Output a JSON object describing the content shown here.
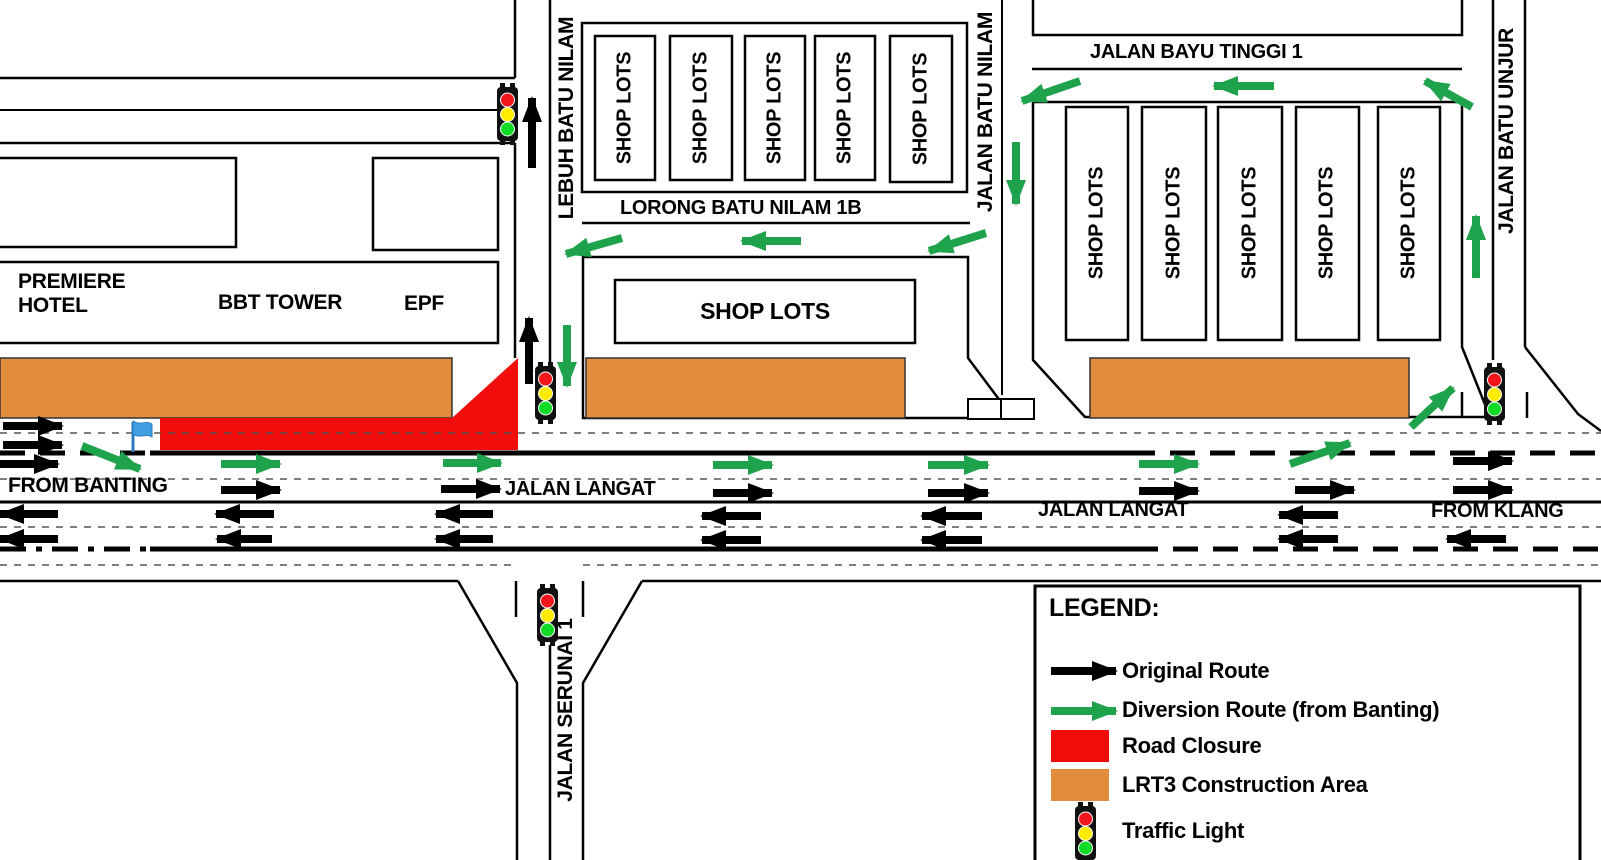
{
  "labels": {
    "premiere_hotel": "PREMIERE\nHOTEL",
    "bbt_tower": "BBT TOWER",
    "epf": "EPF",
    "lebuh_batu_nilam": "LEBUH BATU NILAM",
    "shop_lots": "SHOP LOTS",
    "lorong_batu_nilam_1b": "LORONG BATU NILAM 1B",
    "jalan_batu_nilam": "JALAN BATU NILAM",
    "jalan_bayu_tinggi_1": "JALAN BAYU TINGGI 1",
    "jalan_batu_unjur": "JALAN BATU UNJUR",
    "jalan_serunai_1": "JALAN SERUNAI 1",
    "from_banting": "FROM BANTING",
    "from_klang": "FROM KLANG",
    "jalan_langat_west": "JALAN LANGAT",
    "jalan_langat_east": "JALAN LANGAT"
  },
  "legend": {
    "title": "LEGEND:",
    "items": [
      {
        "id": "original-route",
        "label": "Original Route"
      },
      {
        "id": "diversion-route",
        "label": "Diversion Route (from Banting)"
      },
      {
        "id": "road-closure",
        "label": "Road Closure"
      },
      {
        "id": "construction",
        "label": "LRT3 Construction Area"
      },
      {
        "id": "traffic-light",
        "label": "Traffic Light"
      }
    ]
  },
  "colors": {
    "original_route": "#000000",
    "diversion_route": "#1FA24C",
    "road_closure": "#F20D0D",
    "construction_area": "#E28C3E",
    "traffic_light_red": "#F2151C",
    "traffic_light_yellow": "#FFEB00",
    "traffic_light_green": "#10DC28",
    "flag_blue": "#3F9FE0"
  },
  "map": {
    "traffic_lights": [
      [
        497,
        87
      ],
      [
        535,
        366
      ],
      [
        1484,
        367
      ],
      [
        537,
        588
      ],
      [
        1075,
        806
      ]
    ],
    "arrows": {
      "original": [
        [
          532,
          168,
          532,
          98
        ],
        [
          529,
          384,
          529,
          318
        ],
        [
          3,
          426,
          62,
          426
        ],
        [
          3,
          445,
          62,
          445
        ],
        [
          0,
          464,
          58,
          464
        ],
        [
          221,
          490,
          280,
          490
        ],
        [
          441,
          489,
          500,
          489
        ],
        [
          713,
          493,
          772,
          493
        ],
        [
          928,
          493,
          988,
          493
        ],
        [
          1139,
          491,
          1198,
          491
        ],
        [
          1295,
          490,
          1354,
          490
        ],
        [
          1453,
          490,
          1512,
          490
        ],
        [
          1453,
          461,
          1512,
          461
        ],
        [
          58,
          514,
          0,
          514
        ],
        [
          274,
          514,
          216,
          514
        ],
        [
          493,
          514,
          436,
          514
        ],
        [
          761,
          516,
          702,
          516
        ],
        [
          982,
          516,
          922,
          516
        ],
        [
          1338,
          515,
          1279,
          515
        ],
        [
          58,
          539,
          0,
          539
        ],
        [
          272,
          539,
          217,
          539
        ],
        [
          493,
          539,
          436,
          539
        ],
        [
          761,
          540,
          702,
          540
        ],
        [
          982,
          540,
          922,
          540
        ],
        [
          1338,
          539,
          1279,
          539
        ],
        [
          1506,
          539,
          1447,
          539
        ],
        [
          1051,
          671,
          1116,
          671
        ]
      ],
      "diversion": [
        [
          82,
          446,
          140,
          469
        ],
        [
          221,
          464,
          280,
          464
        ],
        [
          443,
          463,
          501,
          463
        ],
        [
          713,
          465,
          772,
          465
        ],
        [
          928,
          465,
          988,
          465
        ],
        [
          1139,
          464,
          1198,
          464
        ],
        [
          1290,
          464,
          1350,
          443
        ],
        [
          1411,
          427,
          1453,
          388
        ],
        [
          1476,
          278,
          1476,
          216
        ],
        [
          1472,
          107,
          1425,
          81
        ],
        [
          1274,
          86,
          1214,
          86
        ],
        [
          1080,
          81,
          1022,
          101
        ],
        [
          1016,
          142,
          1016,
          204
        ],
        [
          986,
          233,
          929,
          251
        ],
        [
          801,
          241,
          742,
          241
        ],
        [
          622,
          238,
          566,
          254
        ],
        [
          567,
          325,
          567,
          386
        ],
        [
          1051,
          711,
          1116,
          711
        ]
      ]
    }
  }
}
